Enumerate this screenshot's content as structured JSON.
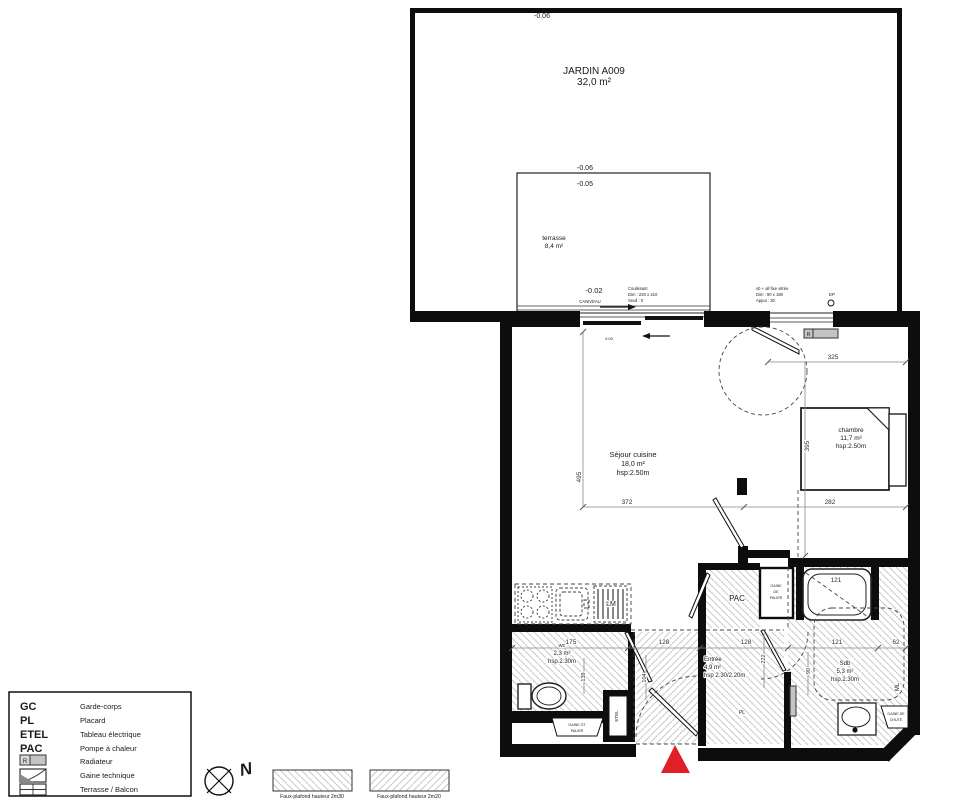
{
  "colors": {
    "wall": "#0d0d0d",
    "red_marker": "#e01f26",
    "hatch": "#c9c9c9",
    "radiator_fill": "#c4c4c4",
    "lm_text": "#445079"
  },
  "garden": {
    "elevation_top": "-0.06",
    "title": "JARDIN A009",
    "area": "32,0 m²"
  },
  "terrace": {
    "elevation_outside": "-0.06",
    "elevation_inside": "-0.05",
    "name": "terrasse",
    "area": "8,4 m²",
    "elevation_threshold": "-0.02",
    "drain_label": "CANIVEAU"
  },
  "annotations": {
    "sliding_door": {
      "line1": "Coulissant",
      "line2": "Dim :  220 x 210",
      "line3": "Seuil :  0"
    },
    "bedroom_window": {
      "line1": "vb + all fixe vitrée",
      "line2": "Dim :  90 x 180",
      "line3": "Appui :  30"
    },
    "rainwater_pipe": "EP",
    "floor_level": "0.00"
  },
  "rooms": {
    "sejour": {
      "name": "Séjour cuisine",
      "area": "18,0 m²",
      "height": "hsp:2.50m"
    },
    "chambre": {
      "name": "chambre",
      "area": "11,7 m²",
      "height": "hsp:2.50m"
    },
    "wc": {
      "name": "wc",
      "area": "2,3 m²",
      "height": "hsp.2.30m"
    },
    "entree": {
      "name": "Entrée",
      "area": "4,9 m²",
      "height": "hsp 2.30/2.20m"
    },
    "sdb": {
      "name": "Sdb",
      "area": "5,3 m²",
      "height": "hsp.2.30m"
    },
    "pac": {
      "name": "PAC"
    }
  },
  "fixtures": {
    "dishwasher": "LM",
    "washing_machine": "ML",
    "electrical_panel": "ETEL",
    "closet": "PL",
    "radiator": "R",
    "duct_center": {
      "line1": "GAINE",
      "line2": "DE",
      "line3": "PALIER"
    },
    "duct_left": {
      "line1": "GAINE GT",
      "line2": "PALIER"
    },
    "duct_right": {
      "line1": "GAINE DE",
      "line2": "CHUTE"
    }
  },
  "dims": {
    "d495": "495",
    "d372": "372",
    "d282": "282",
    "d325": "325",
    "d395": "395",
    "d175": "175",
    "d128a": "128",
    "d128b": "128",
    "d121_tub": "121",
    "d121": "121",
    "d62": "62",
    "d139": "139",
    "d104": "104",
    "d222": "222",
    "d90": "90"
  },
  "legend": {
    "rows": [
      {
        "abbr": "GC",
        "label": "Garde-corps"
      },
      {
        "abbr": "PL",
        "label": "Placard"
      },
      {
        "abbr": "ETEL",
        "label": "Tableau électrique"
      },
      {
        "abbr": "PAC",
        "label": "Pompe à chaleur"
      },
      {
        "abbr": "R",
        "label": "Radiateur"
      },
      {
        "abbr": "",
        "label": "Gaine technique"
      },
      {
        "abbr": "",
        "label": "Terrasse / Balcon"
      }
    ]
  },
  "hatch_legend": {
    "ceiling_2m30": "Faux-plafond hauteur 2m30",
    "ceiling_2m20": "Faux-plafond hauteur 2m20"
  },
  "compass": {
    "north": "N"
  }
}
